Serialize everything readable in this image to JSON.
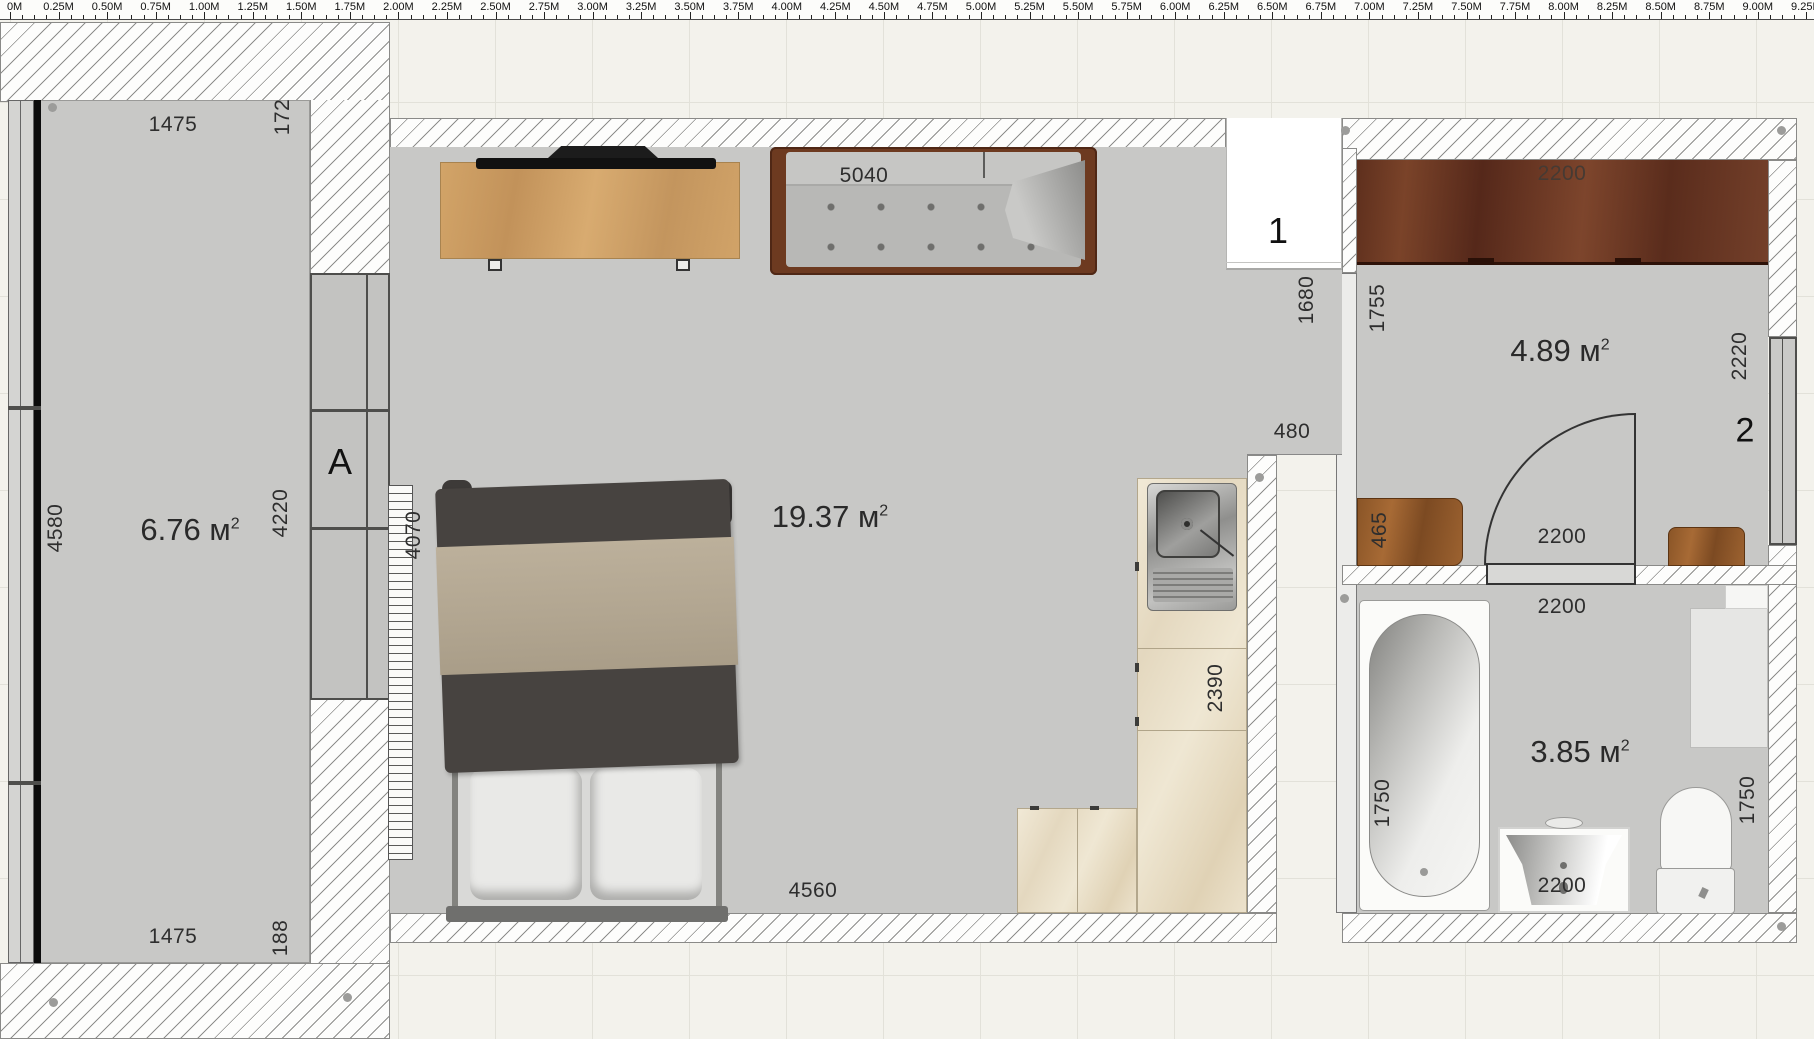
{
  "app": {
    "title": "Floor plan editor"
  },
  "ruler": {
    "unit": "M",
    "labels": [
      "0M",
      "0.25M",
      "0.50M",
      "0.75M",
      "1.00M",
      "1.25M",
      "1.50M",
      "1.75M",
      "2.00M",
      "2.25M",
      "2.50M",
      "2.75M",
      "3.00M",
      "3.25M",
      "3.50M",
      "3.75M",
      "4.00M",
      "4.25M",
      "4.50M",
      "4.75M",
      "5.00M",
      "5.25M",
      "5.50M",
      "5.75M",
      "6.00M",
      "6.25M",
      "6.50M",
      "6.75M",
      "7.00M",
      "7.25M",
      "7.50M",
      "7.75M",
      "8.00M",
      "8.25M",
      "8.50M",
      "8.75M",
      "9.00M",
      "9.25M",
      "9.50M"
    ]
  },
  "rooms": {
    "balcony": {
      "area_value": "6.76",
      "area_unit": "м",
      "area_sup": "2",
      "dim_top": "1475",
      "dim_top_right": "172",
      "dim_left": "4580",
      "dim_right": "4220",
      "dim_bottom": "1475",
      "dim_bottom_right": "188",
      "window_label": "A",
      "radiator_length": "4070"
    },
    "living": {
      "area_value": "19.37",
      "area_unit": "м",
      "area_sup": "2",
      "sofa_width": "5040",
      "dim_bottom": "4560",
      "counter_length": "2390",
      "entry_depth": "1680",
      "passage_width": "480",
      "door_label": "1"
    },
    "hall": {
      "area_value": "4.89",
      "area_unit": "м",
      "area_sup": "2",
      "wardrobe_width": "2200",
      "dim_left": "1755",
      "dim_right": "2220",
      "window_label": "2",
      "door_width": "2200",
      "cabinet_depth": "465"
    },
    "bath": {
      "area_value": "3.85",
      "area_unit": "м",
      "area_sup": "2",
      "dim_top": "2200",
      "tub_length": "1750",
      "toilet_side": "1750",
      "basin_width": "2200"
    }
  },
  "colors": {
    "floor": "#c8c8c6",
    "wall_hatch_line": "#8e8e8c",
    "wood_dark": "#6e3526",
    "wood_light": "#c89a62",
    "accent_text": "#2e2e2e"
  }
}
